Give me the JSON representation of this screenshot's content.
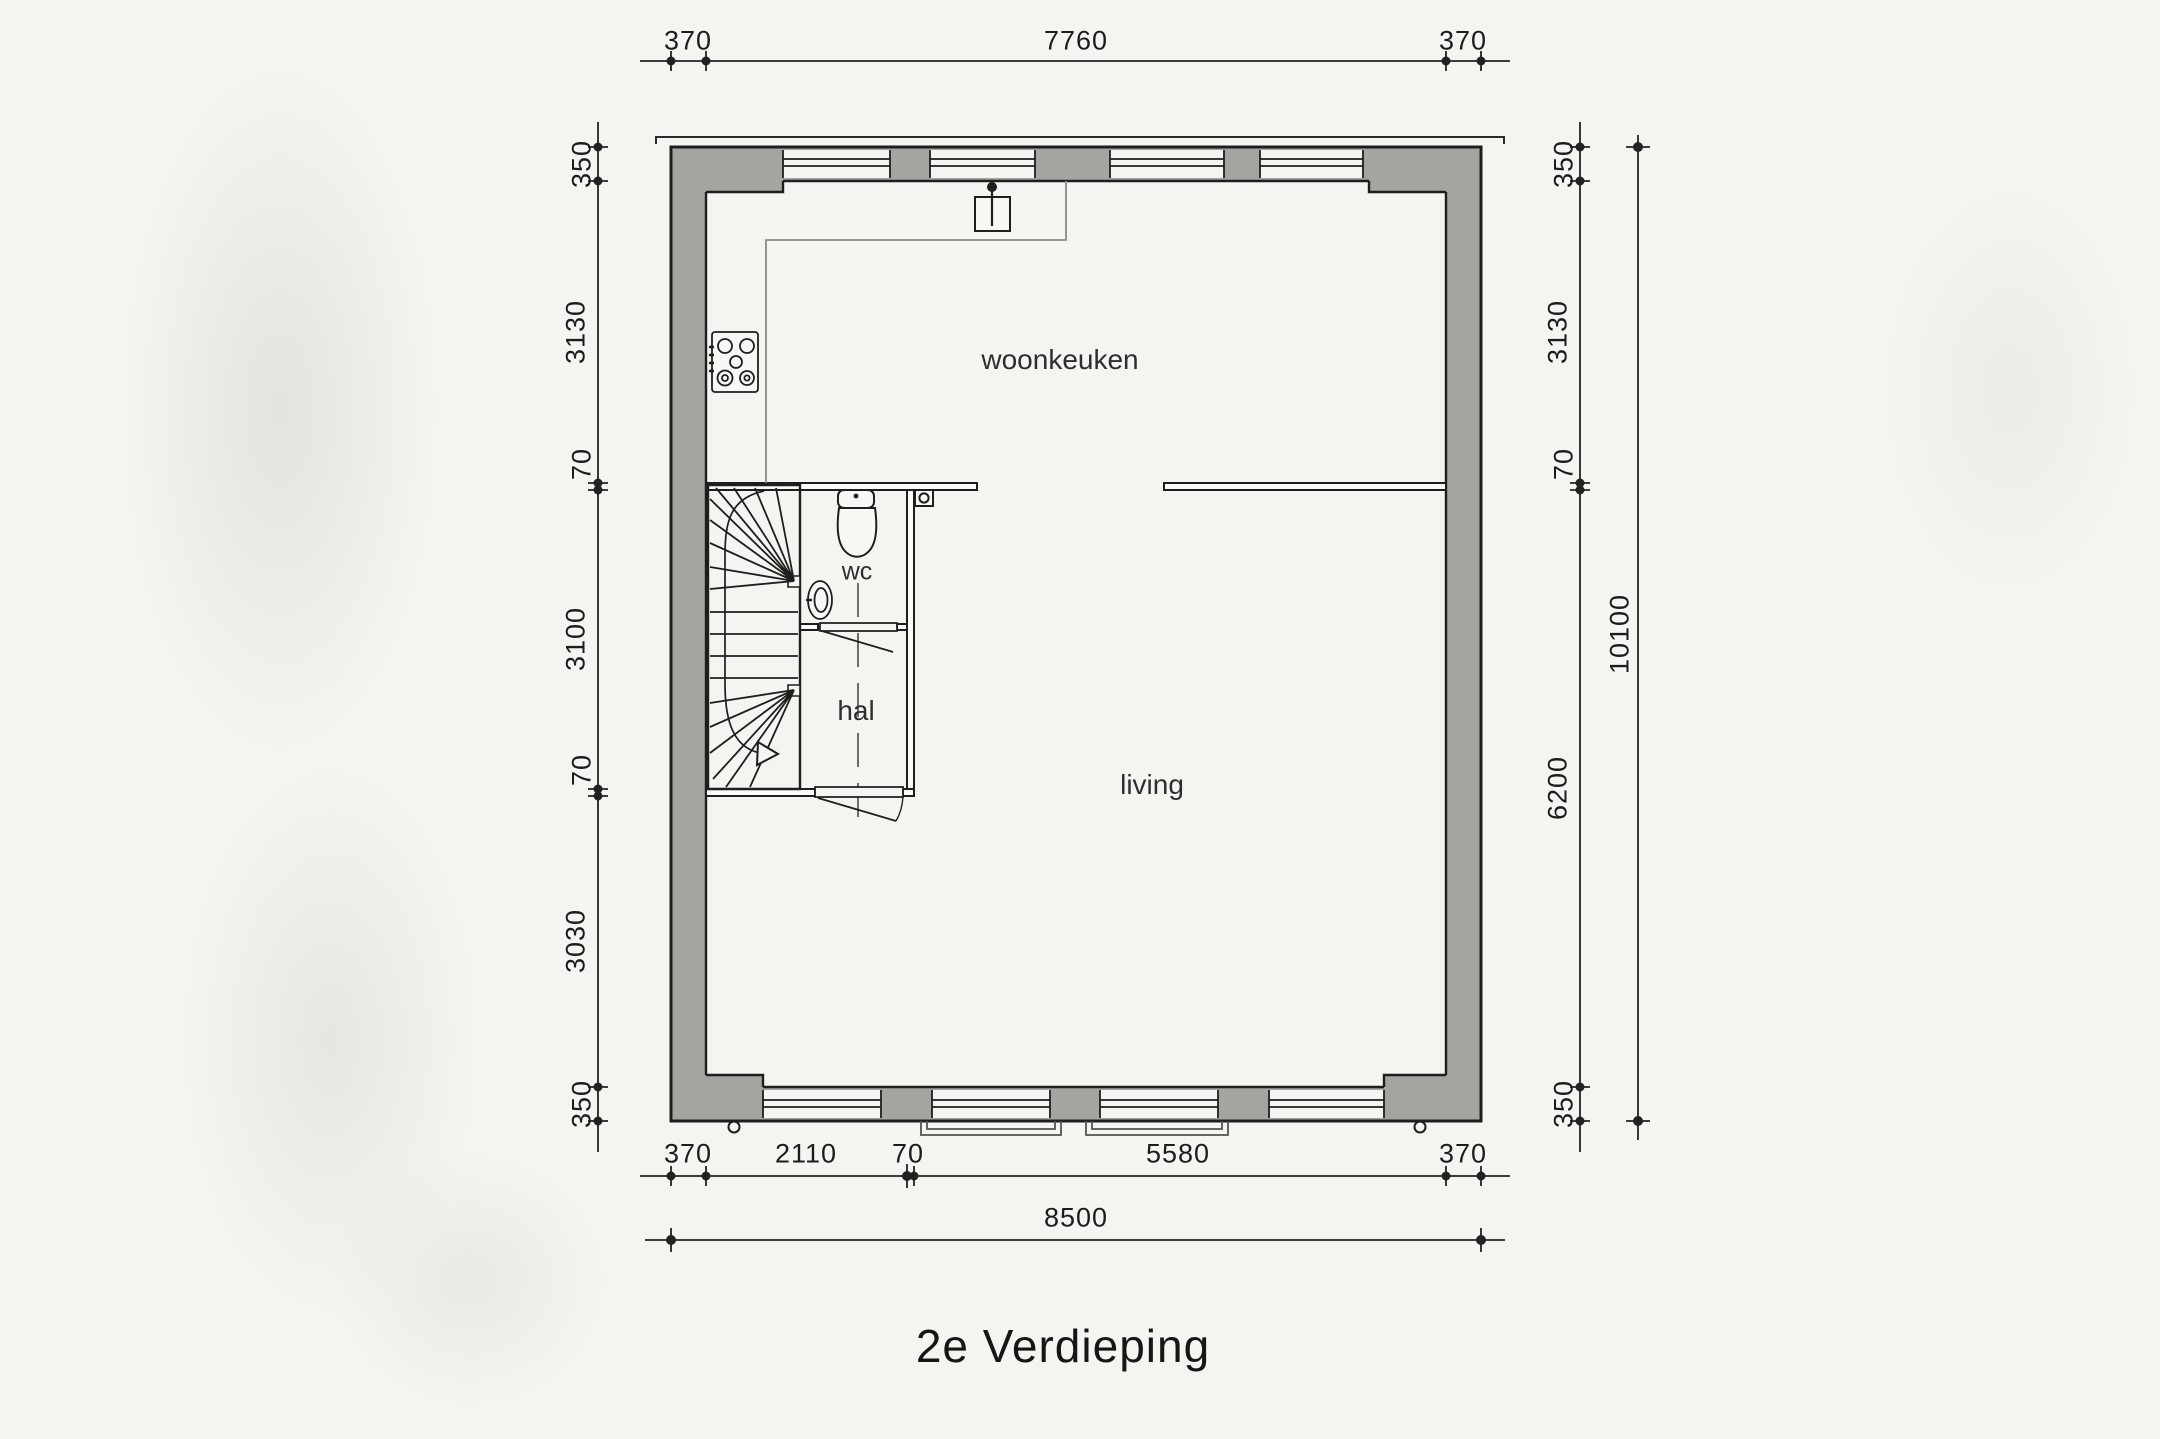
{
  "title": "2e Verdieping",
  "rooms": {
    "kitchen_label": "woonkeuken",
    "wc_label": "wc",
    "hall_label": "hal",
    "living_label": "living"
  },
  "dims": {
    "top": [
      "370",
      "7760",
      "370"
    ],
    "left": [
      "350",
      "3130",
      "70",
      "3100",
      "70",
      "3030",
      "350"
    ],
    "right": [
      "350",
      "3130",
      "70",
      "6200",
      "350"
    ],
    "right_total": "10100",
    "bottom": [
      "370",
      "2110",
      "70",
      "5580",
      "370"
    ],
    "bottom_total": "8500"
  },
  "icons": {
    "stove": "hob-5-burner-icon",
    "flue": "flue-point-icon",
    "toilet": "toilet-icon",
    "sink": "corner-basin-icon",
    "vent": "vent-point-icon",
    "stair_arrow": "stair-up-arrow-icon",
    "downpipe": "rainwater-downpipe-icon",
    "balcony": "french-balcony-railing"
  },
  "colors": {
    "wall_fill": "#a6a4a1",
    "line": "#1e1e1e",
    "paper": "#f5f4f1",
    "counter_line": "#8a8a86"
  }
}
